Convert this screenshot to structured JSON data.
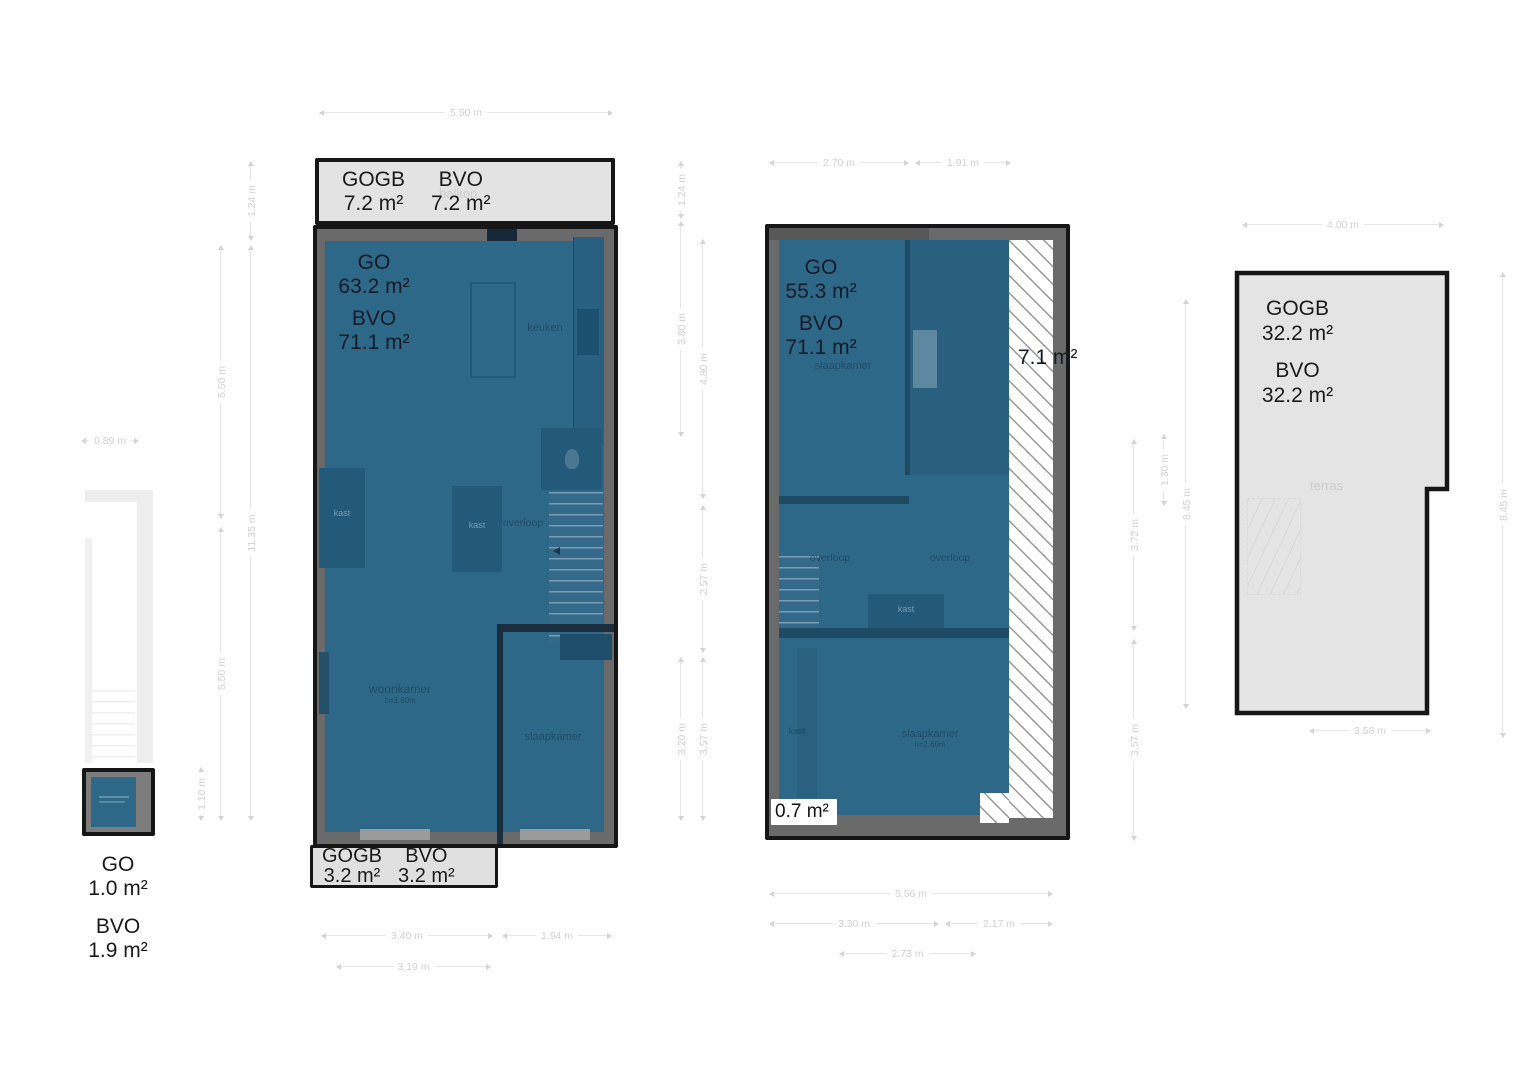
{
  "colors": {
    "floor_blue": "#2e6889",
    "wall_gray": "#6a6a6a",
    "balcony_gray": "#e3e3e3",
    "terrace_gray": "#e4e4e4",
    "outline_black": "#161616",
    "dim_gray": "#d4d4d4",
    "label_dark": "#131c26"
  },
  "units": {
    "a": {
      "go_label": "GO",
      "go_value": "1.0 m²",
      "bvo_label": "BVO",
      "bvo_value": "1.9 m²"
    },
    "b": {
      "balcony_top": {
        "label1": "GOGB",
        "value1": "7.2 m²",
        "label2": "BVO",
        "value2": "7.2 m²",
        "room": "balkon"
      },
      "balcony_bottom": {
        "label1": "GOGB",
        "value1": "3.2 m²",
        "label2": "BVO",
        "value2": "3.2 m²"
      },
      "go_label": "GO",
      "go_value": "63.2 m²",
      "bvo_label": "BVO",
      "bvo_value": "71.1 m²",
      "rooms": {
        "keuken": "keuken",
        "overloop": "overloop",
        "woonkamer": "woonkamer",
        "woonkamer_sub": "h=3.60m",
        "slaapkamer": "slaapkamer",
        "kast": "kast"
      }
    },
    "c": {
      "go_label": "GO",
      "go_value": "55.3 m²",
      "bvo_label": "BVO",
      "bvo_value": "71.1 m²",
      "void_area": "7.1 m²",
      "small_area": "0.7 m²",
      "rooms": {
        "slaapkamer": "slaapkamer",
        "slaapkamer_sub": "h=2.60m",
        "overloop": "overloop",
        "kast": "kast"
      }
    },
    "d": {
      "gogb_label": "GOGB",
      "gogb_value": "32.2 m²",
      "bvo_label": "BVO",
      "bvo_value": "32.2 m²",
      "room": "terras"
    }
  },
  "dims": {
    "a_width": "0.89 m",
    "a_height": "1.10 m",
    "b_top": "5.50 m",
    "b_balcony": "1.24 m",
    "b_left_upper": "5.50 m",
    "b_left_lower": "5.50 m",
    "b_left_total": "11.35 m",
    "b_bottom_1": "3.40 m",
    "b_bottom_2": "1.94 m",
    "b_bottom_3": "3.19 m",
    "c_top_1": "2.70 m",
    "c_top_2": "1.91 m",
    "c_balcony": "1.24 m",
    "c_left_1": "3.80 m",
    "c_left_2": "4.80 m",
    "c_left_3": "2.57 m",
    "c_left_4": "3.20 m",
    "c_left_5": "3.57 m",
    "c_bottom_1": "5.56 m",
    "c_bottom_2": "3.30 m",
    "c_bottom_3": "2.17 m",
    "c_bottom_4": "2.73 m",
    "c_right_1": "3.72 m",
    "c_right_2": "3.57 m",
    "c_right_3": "1.30 m",
    "c_right_4": "8.45 m",
    "d_top": "4.00 m",
    "d_right": "8.45 m",
    "d_bottom": "3.58 m"
  }
}
